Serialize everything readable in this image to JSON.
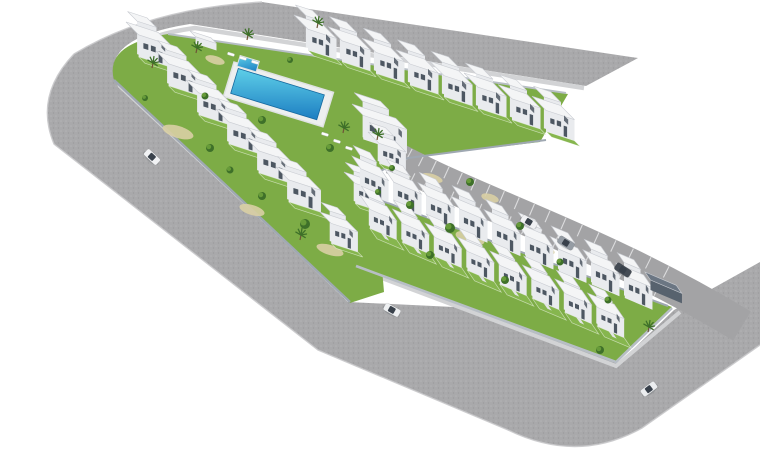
{
  "scene": {
    "background": "#ffffff",
    "palette": {
      "road": "#a9a9ab",
      "roadSpeckA": "#b3b3b5",
      "roadSpeckB": "#9c9c9e",
      "sidewalk": "#d2d3d5",
      "curb": "#c9c9cb",
      "parking": "#a3a3a5",
      "bayLine": "#e6e7e8",
      "lawn": "#7dac46",
      "lawnBright": "#86b64e",
      "wall": "#9fa8b2",
      "wallLight": "#b7bec5",
      "houseTop": "#f4f5f6",
      "houseFront": "#e9ebee",
      "houseSide": "#d6d9de",
      "roofEdge": "#c9ccd2",
      "window": "#4d5762",
      "poolDeck": "#edefef",
      "poolEdge": "#dfe2e3",
      "water1": "#5ecfe8",
      "water2": "#1d7ec2",
      "waterEdge": "#16699f",
      "sand": "#d9cfa4",
      "treeDark": "#3e7029",
      "treeLight": "#6ba03b",
      "trunk": "#6e5437",
      "carGlass": "#39414b",
      "carportTop": "#6b7683",
      "carportFront": "#57626e",
      "carportSide": "#49545f",
      "shadow": "rgba(60,70,80,0.18)"
    },
    "axes": {
      "A1": [
        0.95,
        0.31
      ],
      "B1": [
        0.7,
        0.71
      ],
      "A2": [
        0.92,
        0.39
      ],
      "B2": [
        0.55,
        0.8
      ]
    },
    "roads": {
      "main": "M 638 58 L 262 2 Q 150 8 74 54 Q 34 96 54 144 L 318 350 L 508 430 Q 578 464 642 428 L 760 345 L 760 262 L 674 310 L 620 362 L 475 308 L 348 302 L 116 82 Q 100 38 190 24 L 586 86 Z",
      "curb": "M 262 2 Q 150 8 74 54 Q 34 96 54 144 L 318 350 L 508 430 Q 578 464 642 428 L 760 345",
      "sidewalk1": "M 584 88 L 195 28 Q 106 40 120 86 L 348 298",
      "sidewalk2": "M 360 270 L 616 366 L 680 312"
    },
    "parking": {
      "p0": [
        394,
        158
      ],
      "c1": [
        480,
        205
      ],
      "c2": [
        600,
        240
      ],
      "p3": [
        742,
        326
      ],
      "width": 34,
      "tickStart": 0.04,
      "tickEnd": 0.82,
      "tickStep": 0.045,
      "tickInner": 4,
      "tickOuter": 16.5
    },
    "bases": {
      "upper": "M 168 34 L 568 94 L 540 142 L 408 158 L 374 174 L 384 292 L 350 303 L 114 80 Q 104 44 168 34 Z",
      "lower": "M 358 192 L 672 307 L 616 362 L 356 266 Z"
    },
    "walls": [
      {
        "d": "M 114 80 L 350 302",
        "w": 2.4,
        "c": "wall"
      },
      {
        "d": "M 546 140 L 408 158 L 374 174",
        "w": 2,
        "c": "wall"
      },
      {
        "d": "M 358 192 L 668 306",
        "w": 2,
        "c": "wall"
      },
      {
        "d": "M 356 266 L 616 362 L 672 308",
        "w": 2.6,
        "c": "wallLight"
      },
      {
        "d": "M 168 34 L 566 93",
        "w": 2,
        "c": "wallLight"
      }
    ],
    "pool": {
      "x": 234,
      "y": 62,
      "rot": 17,
      "deck": [
        0,
        0,
        104,
        36
      ],
      "water": [
        6,
        5,
        90,
        26
      ],
      "small": [
        4,
        -8,
        20,
        11
      ]
    },
    "loungers": [
      [
        228,
        52
      ],
      [
        240,
        56
      ],
      [
        252,
        60
      ],
      [
        322,
        132
      ],
      [
        334,
        139
      ],
      [
        346,
        146
      ]
    ],
    "sand": [
      [
        178,
        132,
        16,
        6
      ],
      [
        252,
        210,
        13,
        5
      ],
      [
        330,
        250,
        14,
        5
      ],
      [
        470,
        238,
        15,
        6
      ],
      [
        432,
        178,
        11,
        4
      ],
      [
        292,
        84,
        11,
        4
      ],
      [
        490,
        198,
        9,
        4
      ],
      [
        215,
        60,
        10,
        4
      ],
      [
        545,
        250,
        10,
        4
      ]
    ],
    "buildings": [
      {
        "kind": "single",
        "name": "pool-house",
        "o": [
          190,
          38
        ],
        "wa": 22,
        "wb": 8,
        "h": 7,
        "ax": [
          "A1",
          "B1"
        ],
        "garden": 0,
        "plain": true
      },
      {
        "kind": "row",
        "name": "top-row",
        "n": 8,
        "o": [
          294,
          36
        ],
        "step": [
          34,
          11.6
        ],
        "wa": 30,
        "wb": 20,
        "h": 21,
        "ax": [
          "A1",
          "B1"
        ],
        "garden": 8
      },
      {
        "kind": "row",
        "name": "left-row",
        "n": 6,
        "o": [
          126,
          44
        ],
        "step": [
          30,
          29
        ],
        "wa": 34,
        "wb": 18,
        "h": 22,
        "ax": [
          "A1",
          "B1"
        ],
        "garden": 9
      },
      {
        "kind": "single",
        "name": "clubhouse",
        "o": [
          352,
          128
        ],
        "wa": 46,
        "wb": 16,
        "h": 24,
        "ax": [
          "A1",
          "B1"
        ],
        "garden": 0
      },
      {
        "kind": "row",
        "name": "se-row",
        "n": 3,
        "o": [
          368,
          152
        ],
        "step": [
          -24,
          40
        ],
        "wa": 28,
        "wb": 16,
        "h": 20,
        "ax": [
          "A1",
          "B1"
        ],
        "garden": 7
      },
      {
        "kind": "row",
        "name": "back-row",
        "n": 9,
        "o": [
          352,
          178
        ],
        "step": [
          33,
          13.4
        ],
        "wa": 30,
        "wb": 16,
        "h": 22,
        "ax": [
          "A2",
          "B2"
        ],
        "garden": 0
      },
      {
        "kind": "row",
        "name": "front-row",
        "n": 8,
        "o": [
          360,
          214
        ],
        "step": [
          32.5,
          14
        ],
        "wa": 29,
        "wb": 18,
        "h": 19,
        "ax": [
          "A2",
          "B2"
        ],
        "garden": 13,
        "stairs": true
      },
      {
        "kind": "single",
        "name": "carport",
        "o": [
          645,
          282
        ],
        "wa": 34,
        "wb": 10,
        "h": 10,
        "ax": [
          "A2",
          "B2"
        ],
        "garden": 0,
        "dark": true,
        "plain": true
      }
    ],
    "bushes": [
      [
        210,
        148,
        4
      ],
      [
        262,
        196,
        4
      ],
      [
        305,
        224,
        5
      ],
      [
        410,
        205,
        4
      ],
      [
        450,
        228,
        5
      ],
      [
        378,
        192,
        3
      ],
      [
        205,
        96,
        3.5
      ],
      [
        262,
        120,
        4
      ],
      [
        330,
        148,
        4
      ],
      [
        392,
        168,
        3
      ],
      [
        470,
        182,
        4
      ],
      [
        520,
        226,
        4
      ],
      [
        560,
        262,
        3.5
      ],
      [
        608,
        300,
        3.5
      ],
      [
        600,
        350,
        4
      ],
      [
        145,
        98,
        3
      ],
      [
        230,
        170,
        3.5
      ],
      [
        290,
        60,
        3
      ],
      [
        430,
        255,
        4
      ],
      [
        505,
        280,
        4
      ]
    ],
    "palms": [
      [
        343,
        133
      ],
      [
        377,
        140
      ],
      [
        317,
        28
      ],
      [
        247,
        40
      ],
      [
        152,
        68
      ],
      [
        300,
        240
      ],
      [
        648,
        332
      ],
      [
        196,
        53
      ]
    ],
    "cars": [
      {
        "x": 152,
        "y": 157,
        "rot": 43,
        "c": "#f1f2f4"
      },
      {
        "x": 392,
        "y": 310,
        "rot": 29,
        "c": "#eef0f2"
      },
      {
        "x": 529,
        "y": 222,
        "rot": 31,
        "c": "#f0f1f3"
      },
      {
        "x": 566,
        "y": 243,
        "rot": 32,
        "c": "#959ca4"
      },
      {
        "x": 623,
        "y": 270,
        "rot": 33,
        "c": "#454c55"
      },
      {
        "x": 649,
        "y": 389,
        "rot": -37,
        "c": "#ebedef"
      }
    ]
  }
}
